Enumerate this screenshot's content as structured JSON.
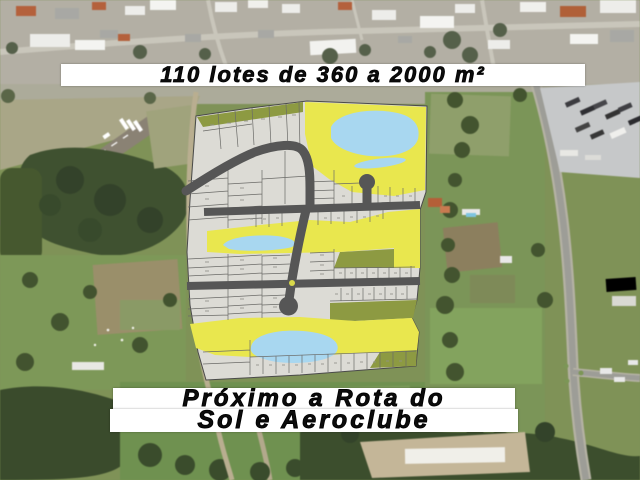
{
  "banners": {
    "top": "110 lotes de 360 a 2000 m²",
    "bottom_line1": "Próximo a Rota do",
    "bottom_line2": "Sol e Aeroclube"
  },
  "map_colors": {
    "lot_fill": "#dcdbd5",
    "open_space_yellow": "#e9e74e",
    "green_area_olive": "#8d9a42",
    "pond_blue": "#a8d7f0",
    "road_gray": "#565656"
  },
  "map_features": [
    "aerial-satellite-photo",
    "subdivision-plat-overlay",
    "airstrip-runway",
    "ponds",
    "highway",
    "forest",
    "urban-area",
    "truck-yard"
  ]
}
